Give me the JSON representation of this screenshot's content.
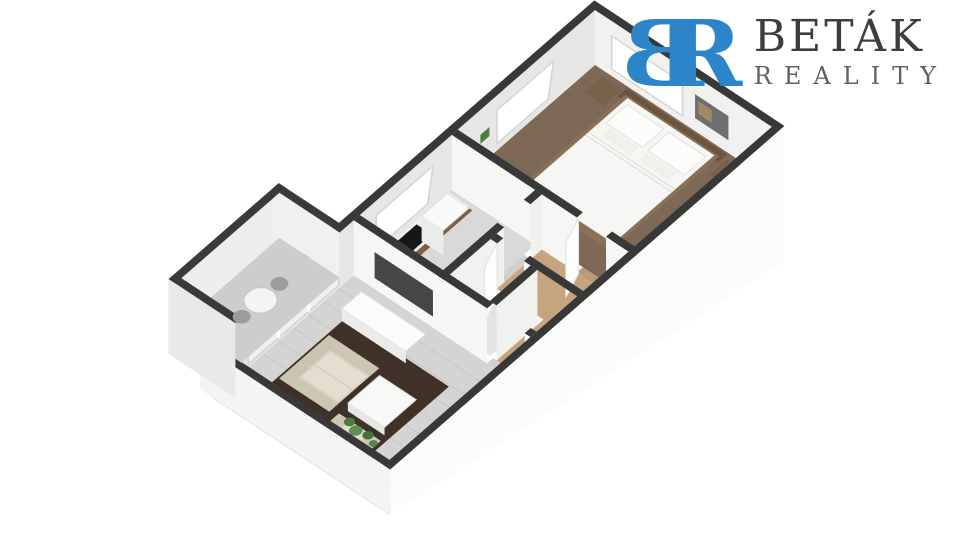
{
  "logo": {
    "monogram": {
      "left_letter": "B",
      "right_letter": "R"
    },
    "name": "BETÁK",
    "subtitle": "REALITY"
  },
  "colors": {
    "background": "#ffffff",
    "logo_blue": "#2d85c9",
    "logo_name_gray": "#3d3d3d",
    "logo_subtitle_gray": "#616161",
    "wall_cut_top": "#383838",
    "wall_face_white": "#f4f4f2",
    "wall_face_shaded": "#c6c6c4",
    "bedroom_wood_floor": "#7d6955",
    "hallway_wood_floor": "#c4a57f",
    "living_floor_gray": "#d4d4d2",
    "rug_dark_brown": "#3f3127",
    "sofa_beige": "#d8d1c1",
    "furniture_wood": "#6e583f",
    "cooktop_black": "#161616",
    "plant_green": "#4e7d46"
  },
  "scene": {
    "type": "3d-floor-plan-render",
    "view": "isometric cutaway, one-bedroom apartment",
    "rooms": [
      {
        "name": "bedroom",
        "items": [
          "double-bed",
          "pillows",
          "headboard",
          "nightstand",
          "nightstand",
          "wardrobe",
          "wall-art",
          "window",
          "window"
        ]
      },
      {
        "name": "kitchen",
        "items": [
          "kitchen-counter",
          "cooktop",
          "sink",
          "tall-cabinet",
          "potted-plant",
          "window"
        ]
      },
      {
        "name": "hallway",
        "items": [
          "door",
          "door"
        ]
      },
      {
        "name": "bathroom",
        "items": []
      },
      {
        "name": "living-room",
        "items": [
          "sofa",
          "armchair",
          "coffee-table",
          "rug",
          "tv",
          "tv-sideboard",
          "glass-door",
          "plants"
        ]
      },
      {
        "name": "balcony",
        "items": [
          "round-table",
          "chair",
          "chair"
        ]
      }
    ]
  }
}
